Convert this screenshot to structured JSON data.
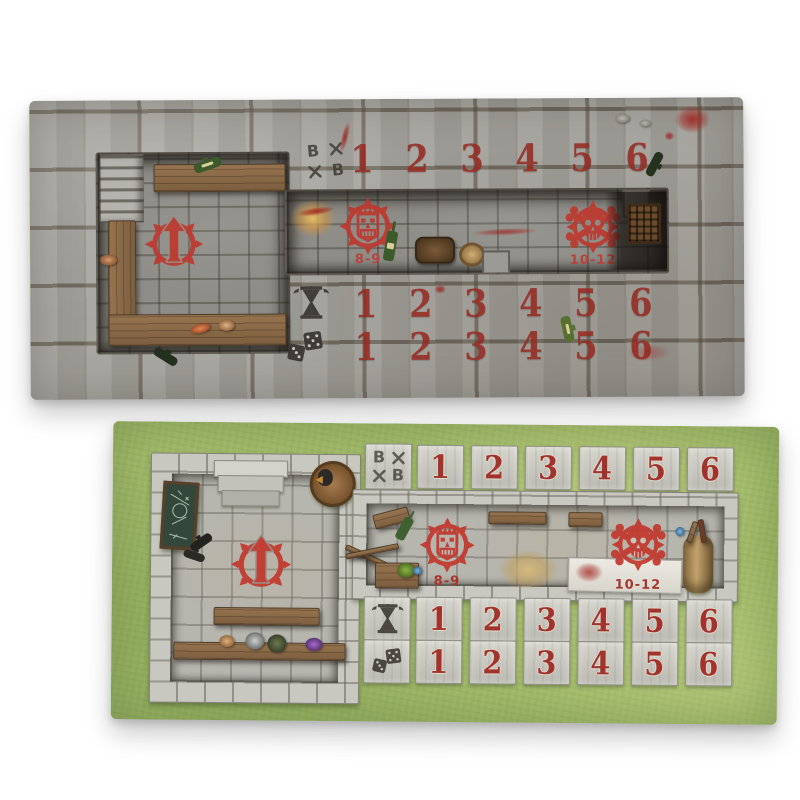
{
  "product": {
    "description": "Two double-sided Blood Bowl dugout boards: a stone dungeon-styled dugout and a grass pitch-side dugout",
    "colors": {
      "page_background": "#ffffff",
      "emblem_red": "#bd3a30",
      "number_red": "#a1332c",
      "stone_gray": "#a4a29c",
      "light_stone": "#c9c8c0",
      "grass_green": "#a2bb69",
      "wood_brown": "#8a6a48",
      "ink_dark": "#34312d"
    }
  },
  "boards": {
    "dungeon": {
      "name": "stone dungeon dugout board",
      "bb_letters": [
        "B",
        "B"
      ],
      "ko_label": "8-9",
      "casualty_label": "10-12",
      "score_track": [
        "1",
        "2",
        "3",
        "4",
        "5",
        "6"
      ],
      "turn_track": [
        "1",
        "2",
        "3",
        "4",
        "5",
        "6"
      ],
      "reroll_track": [
        "1",
        "2",
        "3",
        "4",
        "5",
        "6"
      ]
    },
    "grass": {
      "name": "grass pitch dugout board",
      "bb_letters": [
        "B",
        "B"
      ],
      "ko_label": "8-9",
      "casualty_label": "10-12",
      "score_track": [
        "1",
        "2",
        "3",
        "4",
        "5",
        "6"
      ],
      "turn_track": [
        "1",
        "2",
        "3",
        "4",
        "5",
        "6"
      ],
      "reroll_track": [
        "1",
        "2",
        "3",
        "4",
        "5",
        "6"
      ]
    }
  }
}
